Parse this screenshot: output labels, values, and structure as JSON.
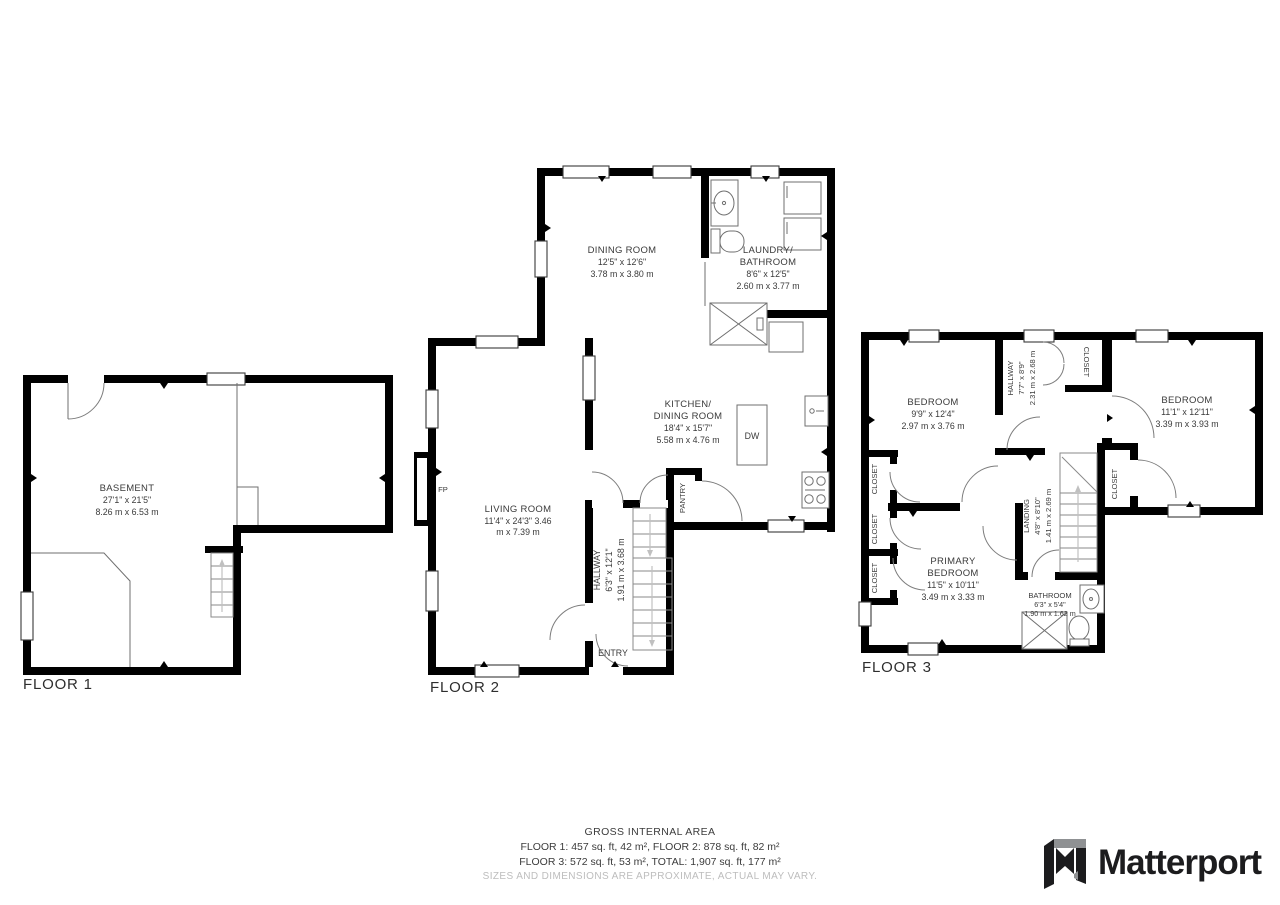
{
  "floor1": {
    "label": "FLOOR 1",
    "basement": {
      "name": "BASEMENT",
      "ft": "27'1\" x 21'5\"",
      "m": "8.26 m x 6.53 m"
    }
  },
  "floor2": {
    "label": "FLOOR 2",
    "dining": {
      "name": "DINING ROOM",
      "ft": "12'5\" x 12'6\"",
      "m": "3.78 m x 3.80 m"
    },
    "laundry": {
      "name1": "LAUNDRY/",
      "name2": "BATHROOM",
      "ft": "8'6\" x 12'5\"",
      "m": "2.60 m x 3.77 m"
    },
    "kitchen": {
      "name1": "KITCHEN/",
      "name2": "DINING ROOM",
      "ft": "18'4\" x 15'7\"",
      "m": "5.58 m x 4.76 m"
    },
    "living": {
      "name": "LIVING ROOM",
      "ft": "11'4\" x 24'3\" 3.46",
      "m": "m x 7.39 m"
    },
    "hallway": {
      "name": "HALLWAY",
      "ft": "6'3\" x 12'1\"",
      "m": "1.91 m x 3.68 m"
    },
    "pantry": "PANTRY",
    "entry": "ENTRY",
    "fp": "FP",
    "dw": "DW"
  },
  "floor3": {
    "label": "FLOOR 3",
    "bedroom1": {
      "name": "BEDROOM",
      "ft": "9'9\" x 12'4\"",
      "m": "2.97 m x 3.76 m"
    },
    "hallway": {
      "name": "HALLWAY",
      "ft": "7'7\" x 8'9\"",
      "m": "2.31 m x 2.68 m"
    },
    "bedroom2": {
      "name": "BEDROOM",
      "ft": "11'1\" x 12'11\"",
      "m": "3.39 m x 3.93 m"
    },
    "landing": {
      "name": "LANDING",
      "ft": "4'8\" x 8'10\"",
      "m": "1.41 m x 2.69 m"
    },
    "primary": {
      "name1": "PRIMARY",
      "name2": "BEDROOM",
      "ft": "11'5\" x 10'11\"",
      "m": "3.49 m x 3.33 m"
    },
    "bathroom": {
      "name": "BATHROOM",
      "ft": "6'3\" x 5'4\"",
      "m": "1.90 m x 1.62 m"
    },
    "closet": "CLOSET"
  },
  "footer": {
    "title": "GROSS INTERNAL AREA",
    "line1": "FLOOR 1: 457 sq. ft, 42 m², FLOOR 2: 878 sq. ft, 82 m²",
    "line2": "FLOOR 3: 572 sq. ft, 53 m², TOTAL: 1,907 sq. ft, 177 m²",
    "disclaimer": "SIZES AND DIMENSIONS ARE APPROXIMATE, ACTUAL MAY VARY."
  },
  "brand": {
    "name": "Matterport"
  }
}
